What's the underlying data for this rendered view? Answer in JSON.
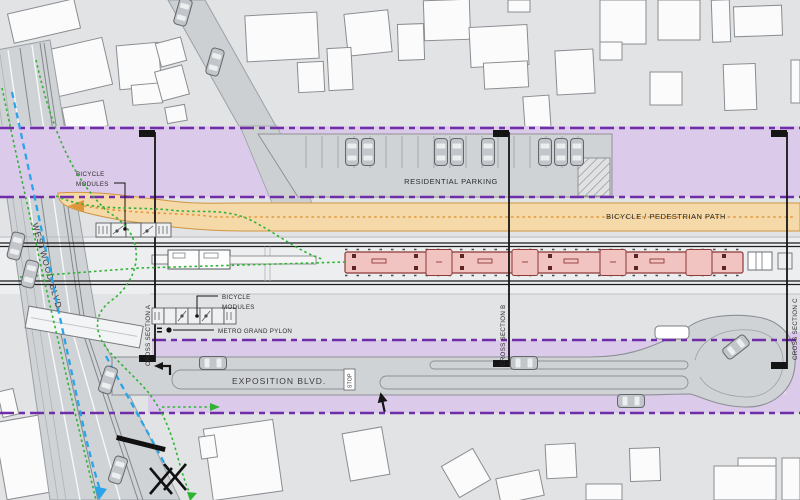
{
  "title": "Transit station area site plan",
  "labels": {
    "westwood_blvd": "WESTWOOD BLVD.",
    "exposition_blvd": "EXPOSITION BLVD.",
    "residential_parking": "RESIDENTIAL PARKING",
    "bicycle_pedestrian_path": "BICYCLE / PEDESTRIAN PATH",
    "bicycle_modules_line1": "BICYCLE",
    "bicycle_modules_line2": "MODULES",
    "metro_grand_pylon": "METRO GRAND PYLON",
    "cross_section_a": "CROSS SECTION A",
    "cross_section_b": "CROSS SECTION B",
    "cross_section_c": "CROSS SECTION C",
    "stop_sign": "STOP"
  },
  "colors": {
    "base_gray": "#e2e3e5",
    "road_gray": "#d0d3d6",
    "building_white": "#fbfbfc",
    "row_band_purple": "#dccaea",
    "row_line_purple": "#6f2da8",
    "bike_path_orange_fill": "#f5d9a8",
    "bike_path_orange_line": "#e0973a",
    "train_pink": "#f1c3c1",
    "train_outline": "#8c3a38",
    "bike_route_green": "#2fb335",
    "bike_lane_blue": "#2aa5e8",
    "rail_black": "#1c1c1c"
  }
}
